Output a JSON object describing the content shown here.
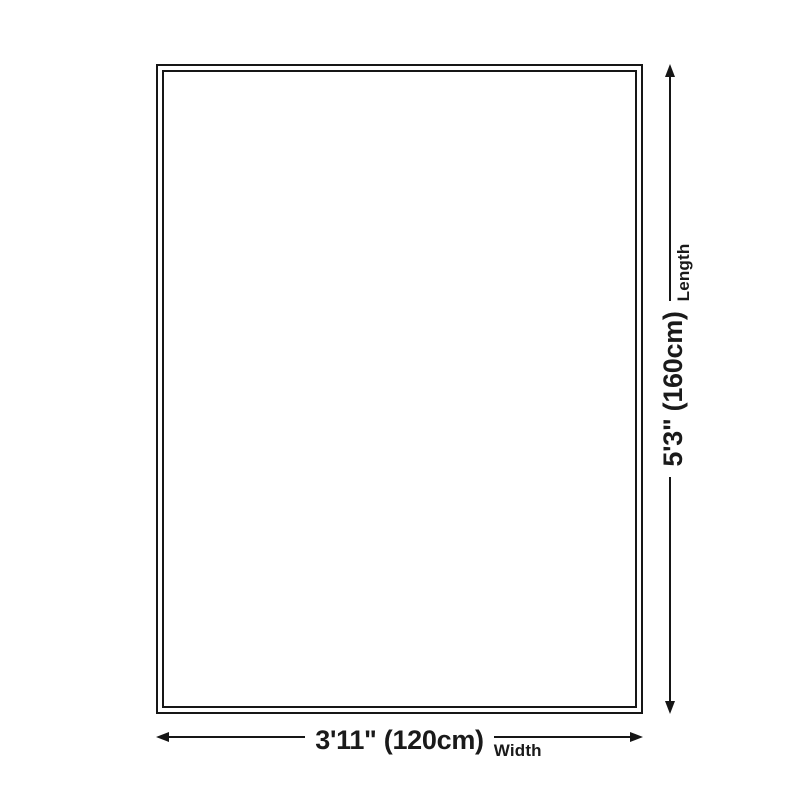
{
  "diagram": {
    "type": "product-size-diagram",
    "colors": {
      "background": "#ffffff",
      "outline": "#161616",
      "text": "#1a1a1a"
    },
    "width_dimension": {
      "value": "3'11\" (120cm)",
      "label": "Width"
    },
    "length_dimension": {
      "value": "5'3\" (160cm)",
      "label": "Length"
    }
  }
}
